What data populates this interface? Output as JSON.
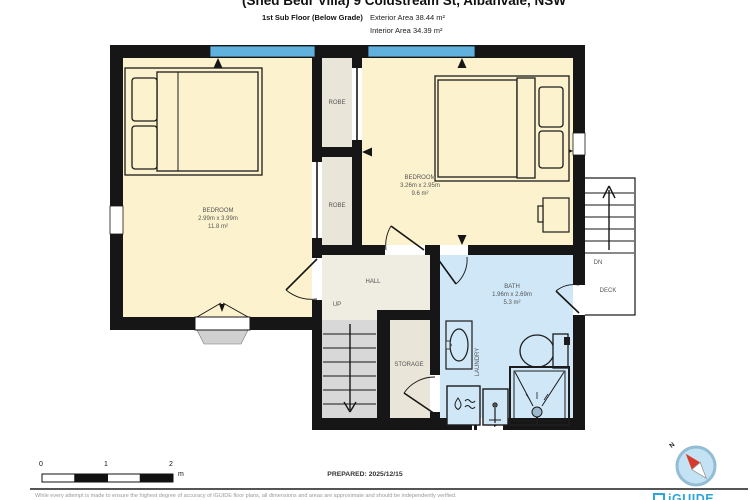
{
  "header": {
    "title": "(Shed Bedr Villa) 9 Coldstream St, Albanvale, NSW",
    "floor_label": "1st Sub Floor (Below Grade)",
    "exterior_area": "Exterior Area 38.44 m²",
    "interior_area": "Interior Area 34.39 m²"
  },
  "rooms": {
    "bedroom_left": {
      "name": "BEDROOM",
      "dims": "2.99m x 3.99m",
      "area": "11.8 m²"
    },
    "bedroom_right": {
      "name": "BEDROOM",
      "dims": "3.26m x 2.95m",
      "area": "9.6 m²"
    },
    "bath": {
      "name": "BATH",
      "dims": "1.96m x 2.69m",
      "area": "5.3 m²"
    },
    "robe_top": {
      "name": "ROBE"
    },
    "robe_bottom": {
      "name": "ROBE"
    },
    "hall": {
      "name": "HALL"
    },
    "storage": {
      "name": "STORAGE"
    },
    "laundry": {
      "name": "LAUNDRY"
    },
    "deck": {
      "name": "DECK"
    }
  },
  "stairs": {
    "up_label": "UP",
    "down_label": "DN"
  },
  "scale_bar": {
    "ticks": [
      "0",
      "1",
      "2"
    ],
    "unit": "m"
  },
  "compass": {
    "north_label": "N"
  },
  "footer": {
    "prepared": "PREPARED: 2025/12/15",
    "disclaimer": "While every attempt is made to ensure the highest degree of accuracy of iGUIDE floor plans, all dimensions and areas are approximate and should be independently verified.",
    "brand": "iGUIDE"
  },
  "colors": {
    "bedroom_fill": "#fcf2cd",
    "closet_fill": "#eae5d9",
    "hall_fill": "#efece1",
    "bath_fill": "#cfe7f7",
    "stairs_fill": "#d8d8d8",
    "wall": "#161616",
    "window_blue": "#60b1dd",
    "brand_blue": "#2aa5e0",
    "compass_fill": "#c3e2f3",
    "needle_red": "#d93a2b"
  }
}
